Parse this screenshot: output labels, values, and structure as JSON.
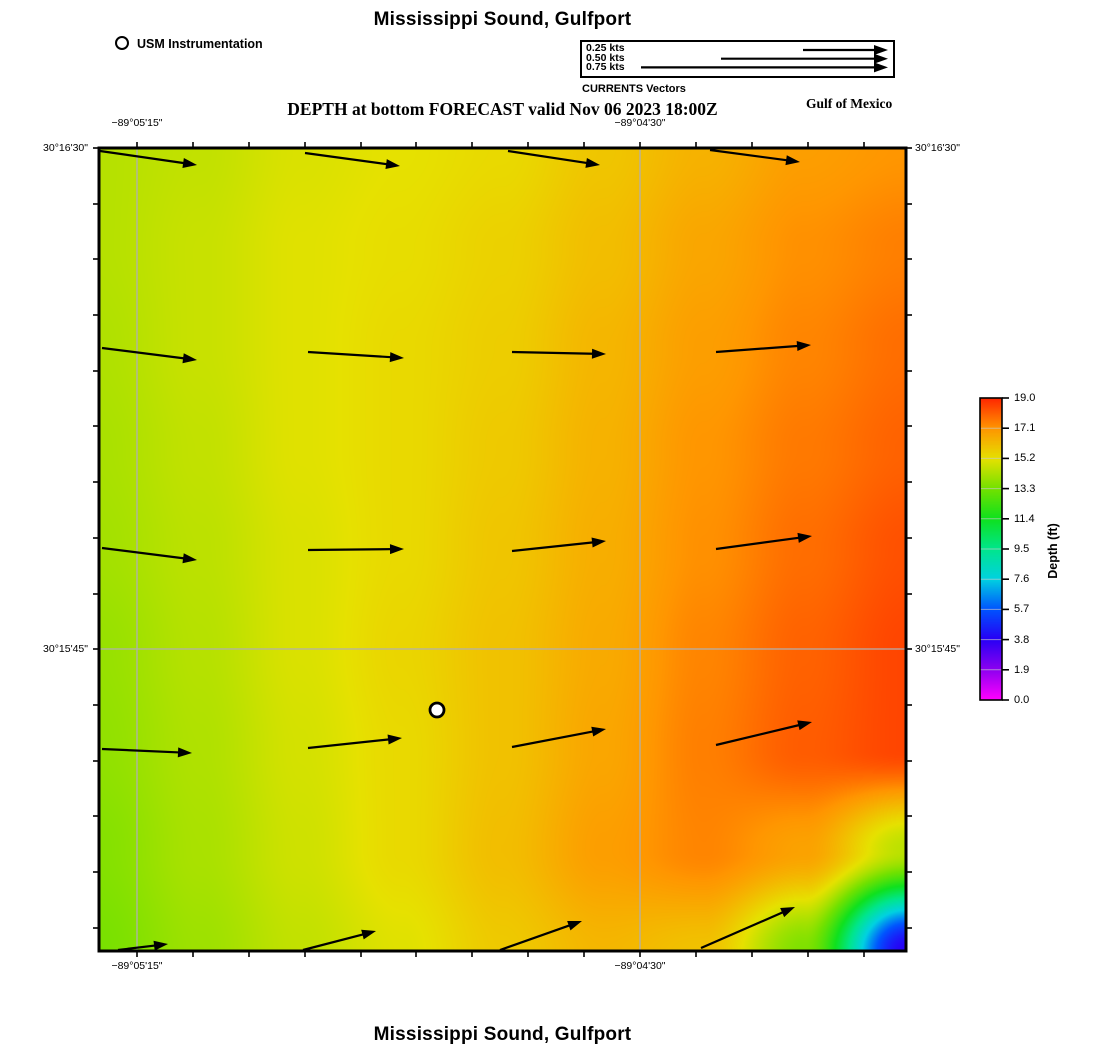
{
  "title_top": "Mississippi Sound, Gulfport",
  "subtitle": "DEPTH at bottom FORECAST valid Nov 06 2023 18:00Z",
  "title_bottom": "Mississippi Sound, Gulfport",
  "region_label": "Gulf of Mexico",
  "station_legend": {
    "label": "USM Instrumentation",
    "marker": "open-circle"
  },
  "vector_legend": {
    "caption": "CURRENTS Vectors",
    "head_x": 888,
    "box": {
      "x": 580,
      "y": 40,
      "w": 315,
      "h": 38
    },
    "entries": [
      {
        "label": "0.25 kts",
        "tail_x": 803,
        "y": 50
      },
      {
        "label": "0.50 kts",
        "tail_x": 721,
        "y": 58.7
      },
      {
        "label": "0.75 kts",
        "tail_x": 641,
        "y": 67.4
      }
    ]
  },
  "chart_data": {
    "type": "heatmap",
    "title": "Mississippi Sound, Gulfport",
    "subtitle": "DEPTH at bottom FORECAST valid Nov 06 2023 18:00Z",
    "field": "depth_at_bottom",
    "units": "ft",
    "geometry_px": {
      "map": {
        "x": 99,
        "y": 148,
        "w": 807,
        "h": 803
      },
      "colorbar": {
        "x": 980,
        "y": 398,
        "w": 22,
        "h": 302
      }
    },
    "axes": {
      "top_labels": [
        {
          "text": "−89°05'15\"",
          "x": 137
        },
        {
          "text": "−89°04'30\"",
          "x": 640
        }
      ],
      "bottom_labels": [
        {
          "text": "−89°05'15\"",
          "x": 137
        },
        {
          "text": "−89°04'30\"",
          "x": 640
        }
      ],
      "left_labels": [
        {
          "text": "30°16'30\"",
          "y": 148
        },
        {
          "text": "30°15'45\"",
          "y": 649
        }
      ],
      "right_labels": [
        {
          "text": "30°16'30\"",
          "y": 148
        },
        {
          "text": "30°15'45\"",
          "y": 649
        }
      ],
      "minor_tick_x": [
        137,
        193,
        249,
        305,
        361,
        416,
        472,
        528,
        584,
        640,
        696,
        752,
        808,
        864
      ],
      "minor_tick_y": [
        148,
        204,
        259,
        315,
        371,
        426,
        482,
        538,
        594,
        649,
        705,
        761,
        816,
        872,
        928
      ],
      "grid_x": [
        137,
        640
      ],
      "grid_y": [
        649
      ],
      "grid_color": "#b0b0b0"
    },
    "colorbar": {
      "label": "Depth (ft)",
      "min": 0.0,
      "max": 19.0,
      "tick_labels": [
        "19.0",
        "17.1",
        "15.2",
        "13.3",
        "11.4",
        "9.5",
        "7.6",
        "5.7",
        "3.8",
        "1.9",
        "0.0"
      ]
    },
    "colormap_stops": [
      [
        0.0,
        "#ff00ff"
      ],
      [
        1.9,
        "#8c00f0"
      ],
      [
        3.8,
        "#2800f5"
      ],
      [
        5.7,
        "#0055ff"
      ],
      [
        7.6,
        "#00d2e1"
      ],
      [
        9.5,
        "#00e68c"
      ],
      [
        11.4,
        "#0fe11e"
      ],
      [
        13.3,
        "#73e100"
      ],
      [
        15.2,
        "#e6e100"
      ],
      [
        17.1,
        "#ff9600"
      ],
      [
        19.0,
        "#ff2800"
      ]
    ],
    "depth_grid_ft": {
      "nx": 9,
      "ny": 9,
      "values": [
        [
          14.4,
          14.6,
          15.0,
          15.2,
          15.4,
          15.9,
          16.4,
          16.9,
          17.1
        ],
        [
          14.4,
          14.7,
          15.1,
          15.3,
          15.6,
          16.1,
          16.7,
          17.2,
          17.5
        ],
        [
          14.3,
          14.7,
          15.1,
          15.4,
          15.7,
          16.3,
          16.9,
          17.4,
          17.8
        ],
        [
          14.2,
          14.6,
          15.1,
          15.4,
          15.8,
          16.4,
          17.1,
          17.6,
          18.0
        ],
        [
          14.1,
          14.5,
          15.0,
          15.4,
          15.9,
          16.5,
          17.2,
          17.8,
          18.3
        ],
        [
          13.9,
          14.4,
          15.0,
          15.5,
          16.0,
          16.6,
          17.4,
          18.0,
          18.5
        ],
        [
          13.8,
          14.3,
          14.9,
          15.4,
          16.0,
          16.7,
          17.5,
          18.1,
          18.5
        ],
        [
          13.6,
          14.2,
          14.8,
          15.4,
          16.1,
          16.9,
          17.4,
          16.8,
          14.5
        ],
        [
          13.4,
          14.0,
          14.6,
          15.1,
          15.8,
          16.3,
          16.0,
          13.5,
          3.8
        ]
      ]
    },
    "current_vectors_px": [
      [
        100,
        151,
        197,
        165
      ],
      [
        305,
        153,
        400,
        166
      ],
      [
        508,
        151,
        600,
        165
      ],
      [
        710,
        150,
        800,
        162
      ],
      [
        102,
        348,
        197,
        360
      ],
      [
        308,
        352,
        404,
        358
      ],
      [
        512,
        352,
        606,
        354
      ],
      [
        716,
        352,
        811,
        345
      ],
      [
        102,
        548,
        197,
        560
      ],
      [
        308,
        550,
        404,
        549
      ],
      [
        512,
        551,
        606,
        541
      ],
      [
        716,
        549,
        812,
        536
      ],
      [
        102,
        749,
        192,
        753
      ],
      [
        308,
        748,
        402,
        738
      ],
      [
        512,
        747,
        606,
        729
      ],
      [
        716,
        745,
        812,
        722
      ],
      [
        118,
        950,
        168,
        944
      ],
      [
        303,
        950,
        376,
        931
      ],
      [
        500,
        950,
        582,
        921
      ],
      [
        701,
        948,
        795,
        907
      ]
    ],
    "station_marker_px": {
      "x": 437,
      "y": 710,
      "label": "USM Instrumentation"
    }
  }
}
